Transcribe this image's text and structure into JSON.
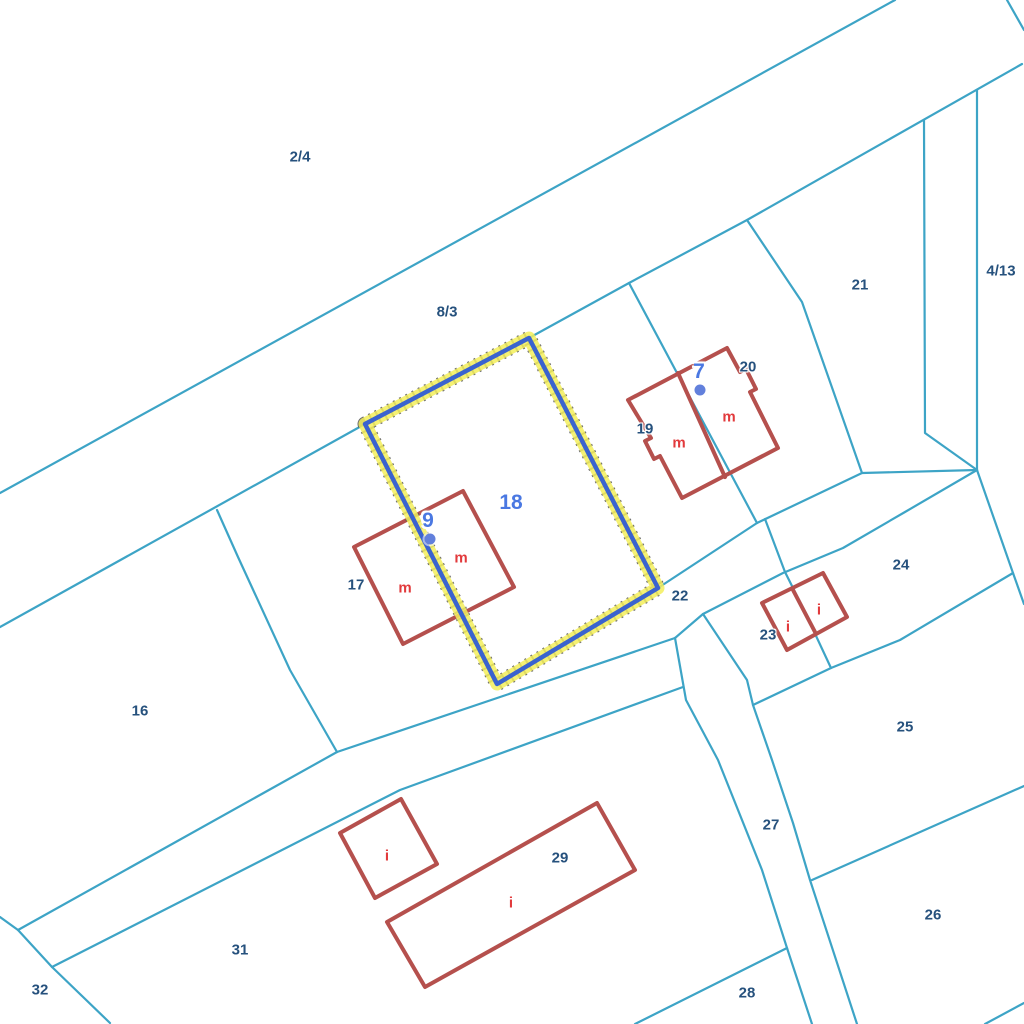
{
  "map": {
    "type": "cadastral-parcel-map",
    "canvas": {
      "width": 1024,
      "height": 1024,
      "background": "#FFFFFF"
    },
    "colors": {
      "boundary_line": "#3DA4C6",
      "building_outline": "#B5504D",
      "building_use_label": "#E23A3C",
      "parcel_label": "#26517D",
      "address_label": "#4A78E2",
      "address_point": "#6280DC",
      "selection_halo": "#F3EE5C",
      "selection_line": "#3A63CF"
    },
    "selection": {
      "selected_parcel": "18"
    },
    "parcel_labels": [
      {
        "text": "2/4",
        "x": 300,
        "y": 157
      },
      {
        "text": "8/3",
        "x": 447,
        "y": 312
      },
      {
        "text": "21",
        "x": 860,
        "y": 285
      },
      {
        "text": "4/13",
        "x": 1001,
        "y": 271
      },
      {
        "text": "20",
        "x": 748,
        "y": 367
      },
      {
        "text": "19",
        "x": 645,
        "y": 429
      },
      {
        "text": "17",
        "x": 356,
        "y": 585
      },
      {
        "text": "16",
        "x": 140,
        "y": 711
      },
      {
        "text": "22",
        "x": 680,
        "y": 596
      },
      {
        "text": "23",
        "x": 768,
        "y": 635
      },
      {
        "text": "24",
        "x": 901,
        "y": 565
      },
      {
        "text": "25",
        "x": 905,
        "y": 727
      },
      {
        "text": "26",
        "x": 933,
        "y": 915
      },
      {
        "text": "27",
        "x": 771,
        "y": 825
      },
      {
        "text": "28",
        "x": 747,
        "y": 993
      },
      {
        "text": "29",
        "x": 560,
        "y": 858
      },
      {
        "text": "31",
        "x": 240,
        "y": 950
      },
      {
        "text": "32",
        "x": 40,
        "y": 990
      }
    ],
    "address_labels": [
      {
        "text": "18",
        "x": 511,
        "y": 503
      },
      {
        "text": "9",
        "x": 428,
        "y": 521
      },
      {
        "text": "7",
        "x": 699,
        "y": 372
      }
    ],
    "building_use_labels": [
      {
        "text": "m",
        "x": 405,
        "y": 588
      },
      {
        "text": "m",
        "x": 461,
        "y": 558
      },
      {
        "text": "m",
        "x": 679,
        "y": 443
      },
      {
        "text": "m",
        "x": 729,
        "y": 417
      },
      {
        "text": "i",
        "x": 387,
        "y": 856
      },
      {
        "text": "i",
        "x": 511,
        "y": 903
      },
      {
        "text": "i",
        "x": 788,
        "y": 627
      },
      {
        "text": "i",
        "x": 819,
        "y": 610
      }
    ],
    "address_points": [
      {
        "x": 430,
        "y": 539
      },
      {
        "x": 700,
        "y": 390
      }
    ]
  }
}
